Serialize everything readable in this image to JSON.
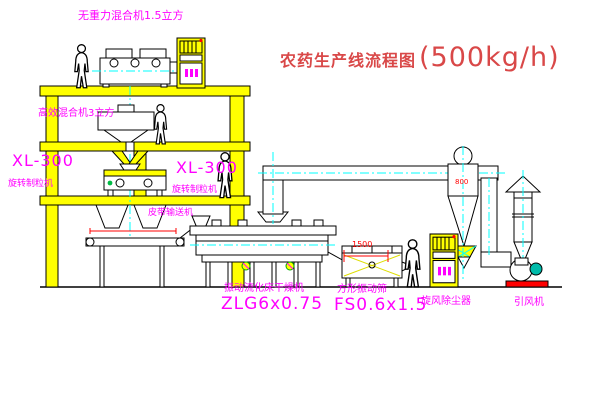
{
  "title": {
    "name": "农药生产线流程图",
    "capacity": "(500kg/h)"
  },
  "labels": {
    "gravity_mixer": "无重力混合机1.5立方",
    "high_mixer": "高效混合机3立方",
    "granulator_left": {
      "model": "XL-300",
      "name": "旋转制粒机"
    },
    "granulator_right": {
      "model": "XL-300",
      "name": "旋转制粒机"
    },
    "belt_conveyor": "皮带输送机",
    "dryer": {
      "name": "振动流化床干燥机",
      "model": "ZLG6x0.75"
    },
    "screen": {
      "name": "方形振动筛",
      "model": "FS0.6x1.5"
    },
    "cyclone": "旋风除尘器",
    "fan": "引风机"
  },
  "dimensions": {
    "screen_feed": "1500",
    "cyclone_width": "800"
  },
  "colors": {
    "structure_yellow": "#ffff00",
    "label_magenta": "#ff00ff",
    "title_red": "#d94848",
    "centerline_cyan": "#00ffff",
    "dimension_red": "#ff0000"
  }
}
